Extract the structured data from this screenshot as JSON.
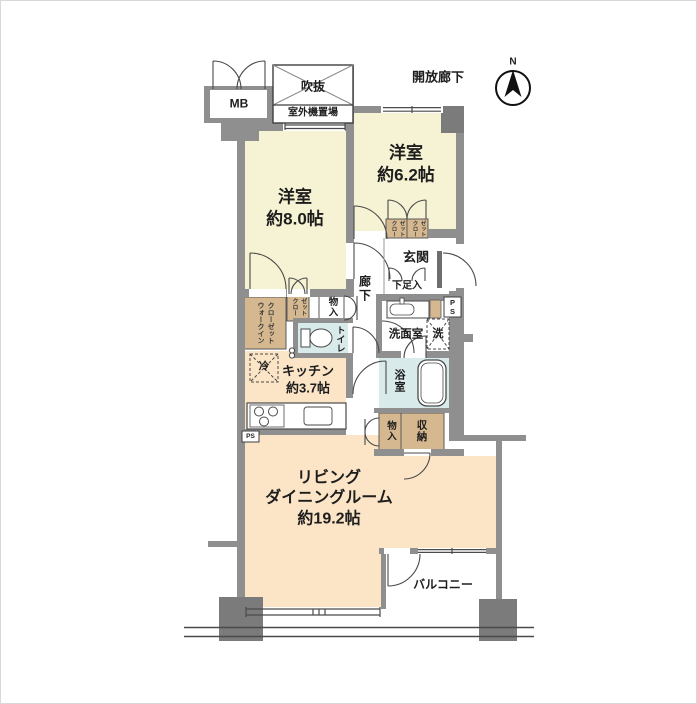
{
  "document": {
    "kind": "apartment-floor-plan"
  },
  "colors": {
    "wall": "#8f8f8f",
    "column": "#7b7b7b",
    "bedroom_fill": "#f6f3d4",
    "living_fill": "#fbe5c6",
    "closet_fill": "#d6b890",
    "wet_area_fill": "#d8eaea",
    "line": "#4a4a4a"
  },
  "labels": {
    "open_corridor": "開放廊下",
    "compass_n": "N",
    "meter_box": "MB",
    "void_space": "吹抜",
    "outdoor_unit": "室外機置場",
    "bedroom1": "洋室\n約8.0帖",
    "bedroom2": "洋室\n約6.2帖",
    "entrance": "玄関",
    "shoe_box": "下足入",
    "corridor": "廊下",
    "pipe_space_entry": "P\nS",
    "washroom": "洗面室",
    "washer": "洗",
    "bathroom": "浴室",
    "toilet": "トイレ",
    "storage_upper": "物入",
    "closet_bedroom1": "クロー\nゼット",
    "walk_in_closet": "ウォークイン\nクローゼット",
    "closet_bedroom2_left": "クロー\nゼット",
    "closet_bedroom2_right": "クロー\nゼット",
    "refrigerator": "冷",
    "kitchen": "キッチン\n約3.7帖",
    "storage_lower": "物入",
    "storage_closet": "収納",
    "living_dining": "リビング\nダイニングルーム\n約19.2帖",
    "balcony": "バルコニー",
    "pipe_space_kitchen": "PS"
  }
}
